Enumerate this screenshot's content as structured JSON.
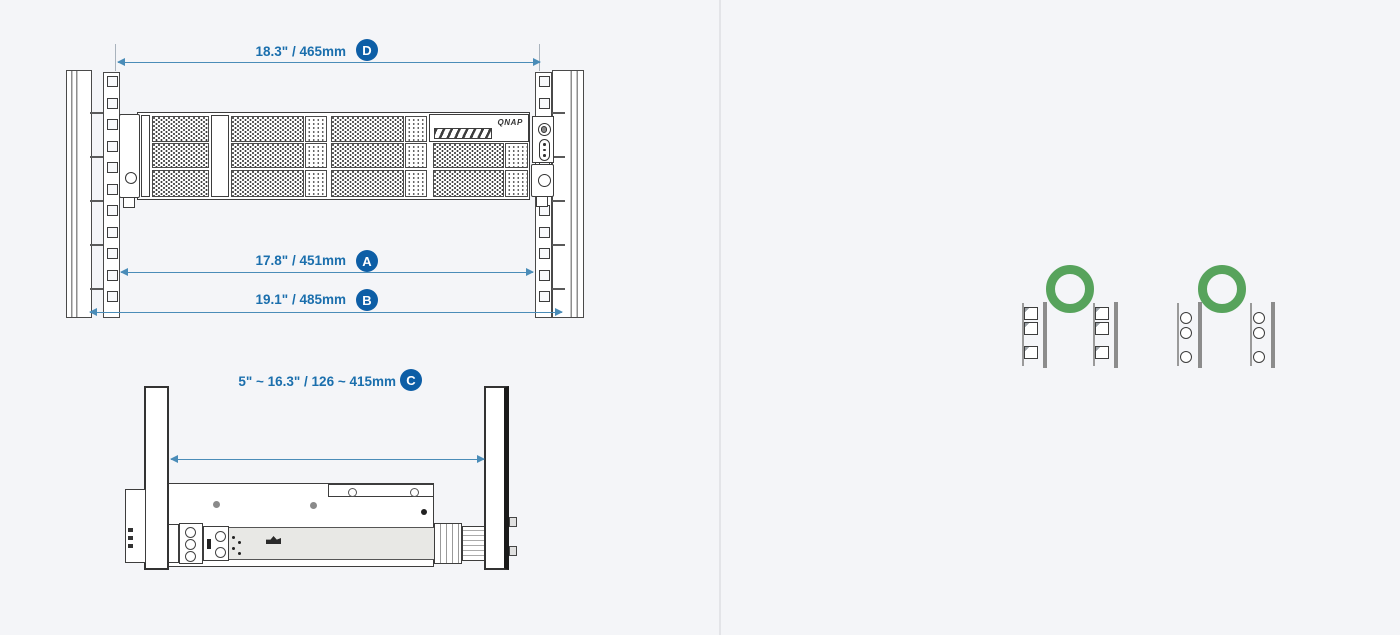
{
  "diagrams": {
    "front_view": {
      "description": "rack front view with QNAP 2U chassis",
      "dimensions": [
        {
          "id": "D",
          "label": "18.3\" / 465mm"
        },
        {
          "id": "A",
          "label": "17.8\" / 451mm"
        },
        {
          "id": "B",
          "label": "19.1\" / 485mm"
        }
      ],
      "logo_text": "QNAP"
    },
    "side_view": {
      "description": "rack side view showing mounting depth range",
      "dimensions": [
        {
          "id": "C",
          "label": "5\" ~ 16.3\" / 126 ~ 415mm"
        }
      ]
    },
    "compatibility": {
      "items": [
        {
          "hole_type": "square-hole-posts",
          "status_icon": "ok-circle"
        },
        {
          "hole_type": "round-hole-posts",
          "status_icon": "ok-circle"
        }
      ]
    }
  },
  "colors": {
    "dimension_text": "#1b6fad",
    "dimension_line": "#4a8cb8",
    "badge_bg": "#0d5ea6",
    "ok_green": "#57a35c"
  }
}
